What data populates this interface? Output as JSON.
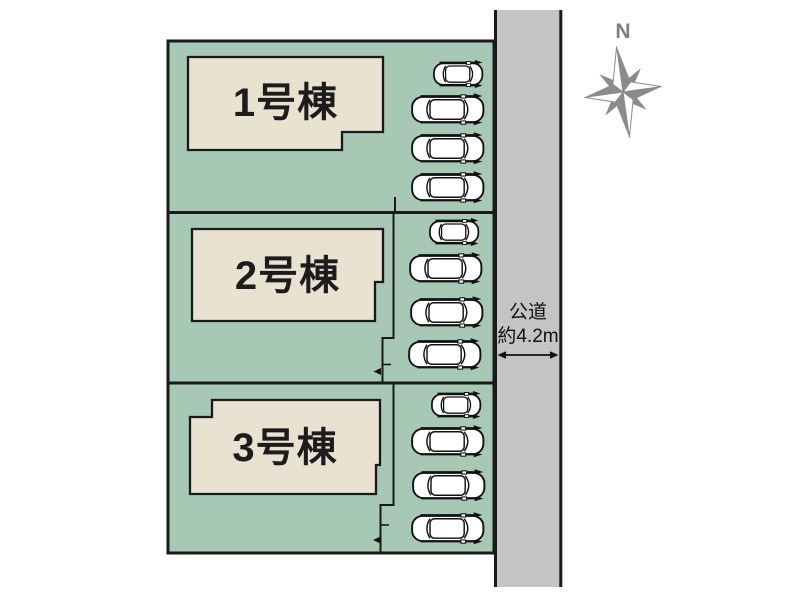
{
  "site_plan": {
    "lots": [
      {
        "name": "lot-1",
        "building_label": "1号棟",
        "parking_spaces": 4
      },
      {
        "name": "lot-2",
        "building_label": "2号棟",
        "parking_spaces": 4
      },
      {
        "name": "lot-3",
        "building_label": "3号棟",
        "parking_spaces": 4
      }
    ],
    "road": {
      "label_line1": "公道",
      "label_line2": "約4.2m"
    },
    "compass": {
      "north_label": "N"
    },
    "colors": {
      "lot_fill": "#a6c8b4",
      "building_fill": "#e9e2d1",
      "road_fill": "#c4c4c4",
      "outline": "#1a1a1a",
      "compass_gray": "#8b8b8b"
    }
  }
}
